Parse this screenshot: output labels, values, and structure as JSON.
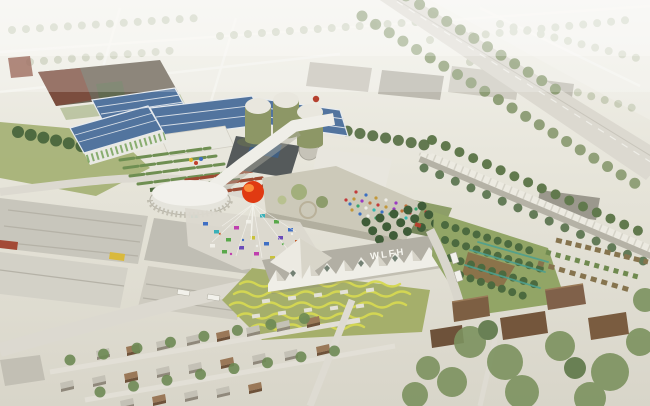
{
  "scene": {
    "description": "Aerial rendering of an urban-farming campus with solar greenhouses, biogas silos, a market square with a red balloon, and a gabled WLFH hall, set in a hazy suburban industrial district beside a highway",
    "roof_sign": "WLFH",
    "palette": {
      "balloon_red": "#e03a12",
      "balloon_highlight": "#ff9a42",
      "solar_blue": "#52749e",
      "silo_olive": "#8d9766",
      "stripe_yellow": "#d6d952",
      "teal_frame": "#4fa08e",
      "crop_red": "#9e4a32",
      "truck_yellow": "#d9b93c",
      "roof_white": "#efeee7",
      "roof_gray": "#b2afa4",
      "lawn_green": "#a7b277",
      "tree_dark": "#4e6a40",
      "haze_white": "#f2f1ea"
    },
    "landmarks": [
      "solar-greenhouse-complex",
      "biogas-silos",
      "elevated-walkway",
      "oval-pavilion",
      "market-plaza",
      "red-balloon",
      "green-roof-amphitheater",
      "wlfh-hall",
      "terraced-gardens",
      "orchard",
      "highway",
      "noise-wall",
      "warehouse-district",
      "residential-blocks"
    ]
  }
}
